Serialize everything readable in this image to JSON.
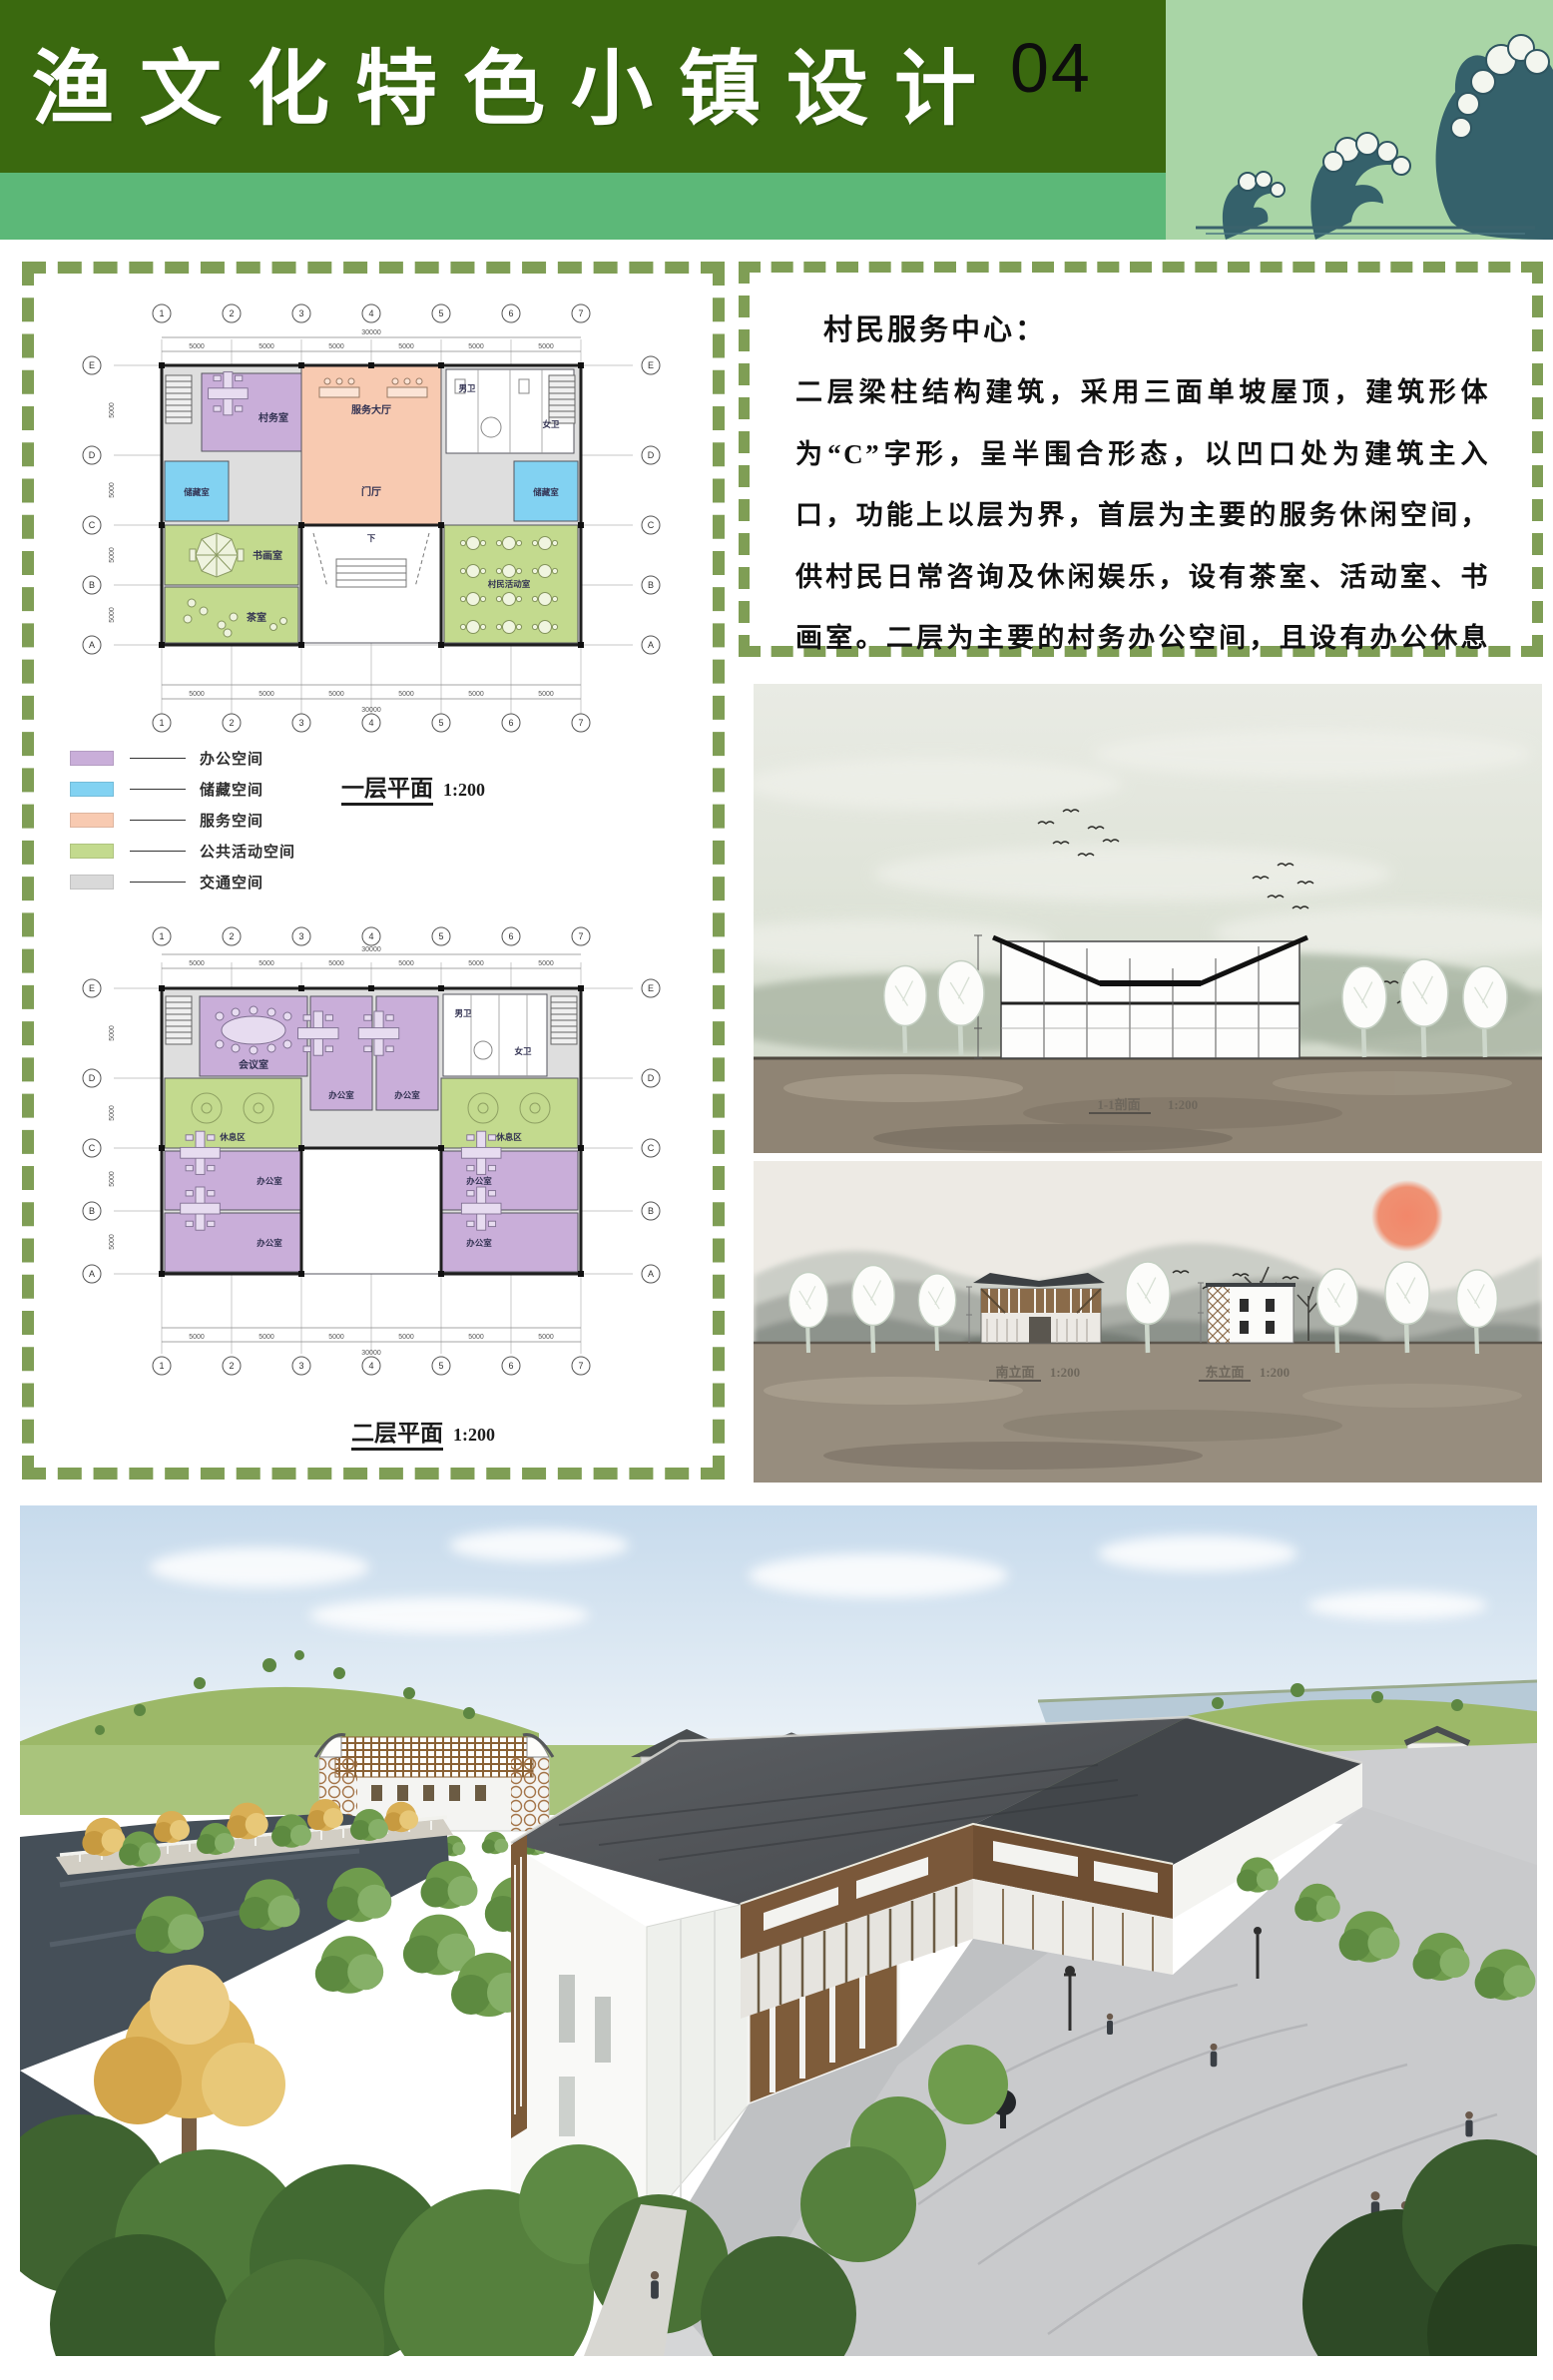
{
  "header": {
    "title": "渔文化特色小镇设计",
    "page_number": "04",
    "wave_icon": "great-wave-illustration"
  },
  "left_panel": {
    "grid_cols": [
      "1",
      "2",
      "3",
      "4",
      "5",
      "6",
      "7"
    ],
    "grid_rows": [
      "E",
      "D",
      "C",
      "B",
      "A"
    ],
    "dim_span": "5000",
    "dim_total": "30000",
    "plan1": {
      "caption": "一层平面",
      "scale": "1:200",
      "rooms": {
        "office": "村务室",
        "hall": "服务大厅",
        "foyer": "门厅",
        "storage": "储藏室",
        "calligraphy": "书画室",
        "tea": "茶室",
        "activity": "村民活动室",
        "wc_m": "男卫",
        "wc_f": "女卫",
        "stair_down": "下"
      }
    },
    "legend": {
      "items": [
        {
          "label": "办公空间",
          "color": "#c9aed9"
        },
        {
          "label": "储藏空间",
          "color": "#82d2f2"
        },
        {
          "label": "服务空间",
          "color": "#f8cab1"
        },
        {
          "label": "公共活动空间",
          "color": "#c3da8e"
        },
        {
          "label": "交通空间",
          "color": "#d9d9d9"
        }
      ]
    },
    "plan2": {
      "caption": "二层平面",
      "scale": "1:200",
      "rooms": {
        "meeting": "会议室",
        "office": "办公室",
        "rest": "休息区",
        "wc_m": "男卫",
        "wc_f": "女卫"
      }
    }
  },
  "right_panel": {
    "heading": "村民服务中心：",
    "body": "二层梁柱结构建筑，采用三面单坡屋顶，建筑形体为“C”字形，呈半围合形态，以凹口处为建筑主入口，功能上以层为界，首层为主要的服务休闲空间，供村民日常咨询及休闲娱乐，设有茶室、活动室、书画室。二层为主要的村务办公空间，且设有办公休息空间"
  },
  "section_view": {
    "caption": "1-1剖面",
    "scale": "1:200"
  },
  "elevation_view": {
    "south_caption": "南立面",
    "east_caption": "东立面",
    "scale": "1:200"
  }
}
